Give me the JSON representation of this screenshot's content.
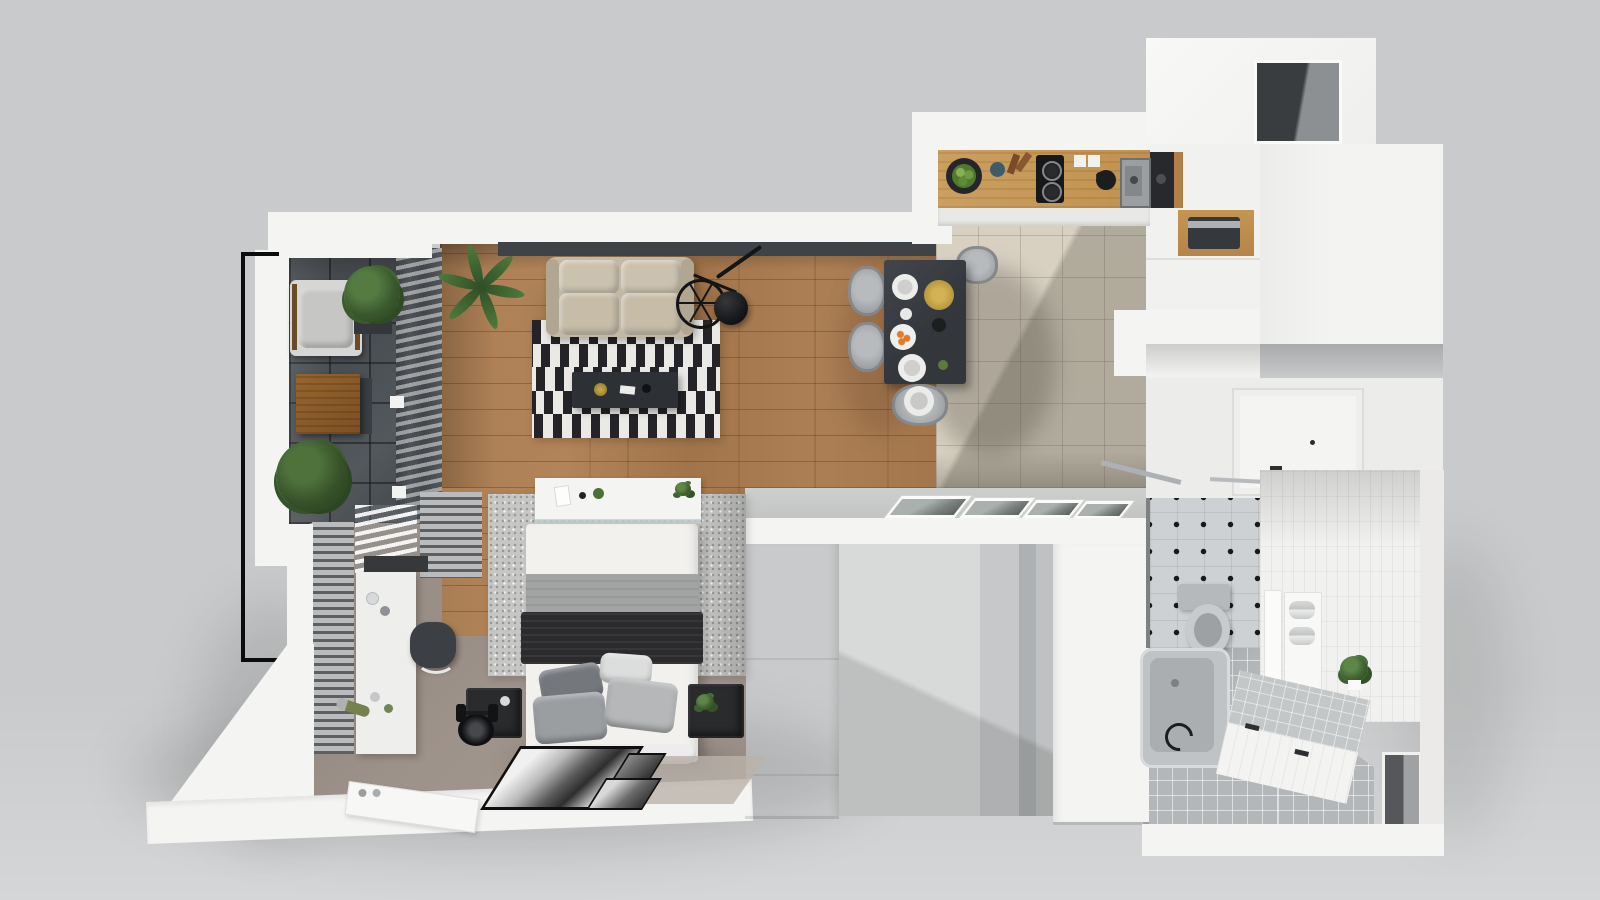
{
  "scene": {
    "type": "3d-floor-plan-top-view-render",
    "background_color": "#c9cacb"
  },
  "palette": {
    "bg": "#c9cacb",
    "bg_light": "#d5d6d7",
    "wall": "#f4f4f2",
    "wall_dim": "#ececea",
    "wall_shade": "#dadbda",
    "ledge": "#3f4347",
    "glass": "#383c40",
    "wood_floor": "#a87c52",
    "wood_counter": "#c79b5c",
    "wood_accent": "#b08048",
    "tile_beige": "#d8d1c2",
    "balcony_tile": "#4d5256",
    "taupe": "#9a8f87",
    "bath_floor_tile": "#b4b7b9",
    "bath_accent": "#ced1d3",
    "white_tile": "#f1f1ef",
    "sofa": "#c2b8a4",
    "sofa_dark": "#b0a692",
    "rug_black": "#242428",
    "rug_white": "#eae9e5",
    "table_dark": "#383c41",
    "coffee_table": "#2d3136",
    "chair_gray": "#a4a7aa",
    "bed_white": "#f2f1ee",
    "blanket_gray": "#a2a3a3",
    "blanket_black": "#2b2b2d",
    "pillow_dark": "#74787d",
    "pillow_mid": "#9a9ea1",
    "pillow_light": "#dcdddd",
    "rug_speckle": "#c6c7c5",
    "crate_dark": "#2a2b2d",
    "plant_green": "#3f6030",
    "plant_dark": "#2c471f",
    "black": "#141517",
    "metal": "#aeb1b3",
    "radiator_light": "#b9bbbd",
    "radiator_dark": "#5d6063",
    "gold": "#b5973f",
    "orange": "#e07b2a",
    "door_white": "#f7f7f5"
  },
  "rooms": [
    {
      "name": "balcony",
      "items": [
        "black-railing",
        "dark-floor-tiles",
        "lounge-chair",
        "wooden-side-table",
        "large-potted-plant",
        "planter-bush"
      ]
    },
    {
      "name": "living-room",
      "items": [
        "beige-sofa",
        "black-white-striped-rug",
        "dark-coffee-table",
        "bicycle",
        "round-black-side-table",
        "palm-plant",
        "dark-wall-ledge",
        "oak-plank-floor",
        "window-blinds"
      ]
    },
    {
      "name": "dining-area",
      "items": [
        "dark-dining-table",
        "gray-chairs",
        "white-plates",
        "gold-tray",
        "orange-fruit-plate",
        "cups"
      ]
    },
    {
      "name": "kitchen",
      "items": [
        "wooden-countertop",
        "two-burner-cooktop",
        "stainless-sink",
        "black-kettle",
        "white-canisters",
        "fruit-bowl",
        "beige-tile-floor",
        "tall-white-cabinets",
        "coffee-machine-niche",
        "built-in-appliance",
        "upper-cabinet-niche"
      ]
    },
    {
      "name": "hallway",
      "items": [
        "white-wardrobe-volume",
        "framed-wall-pictures",
        "inner-gray-wall"
      ]
    },
    {
      "name": "bedroom",
      "items": [
        "double-bed",
        "headboard-shelf",
        "gray-blanket",
        "black-blanket",
        "four-pillows",
        "speckled-area-rug",
        "dark-bedside-crates",
        "white-desk",
        "office-chair",
        "wall-radiators",
        "dumbbell",
        "weight-disc",
        "leaning-framed-pictures",
        "entry-door",
        "light-floor-mat"
      ]
    },
    {
      "name": "bathroom",
      "items": [
        "bathtub",
        "wall-hung-toilet",
        "black-dot-accent-wall",
        "white-tile-walls",
        "gray-tile-floor",
        "tiled-bench",
        "rolled-towels",
        "toilet-paper-roll",
        "green-plant",
        "wall-niche",
        "vanity-mirror-panel",
        "chrome-towel-bar",
        "chrome-faucet"
      ]
    }
  ]
}
